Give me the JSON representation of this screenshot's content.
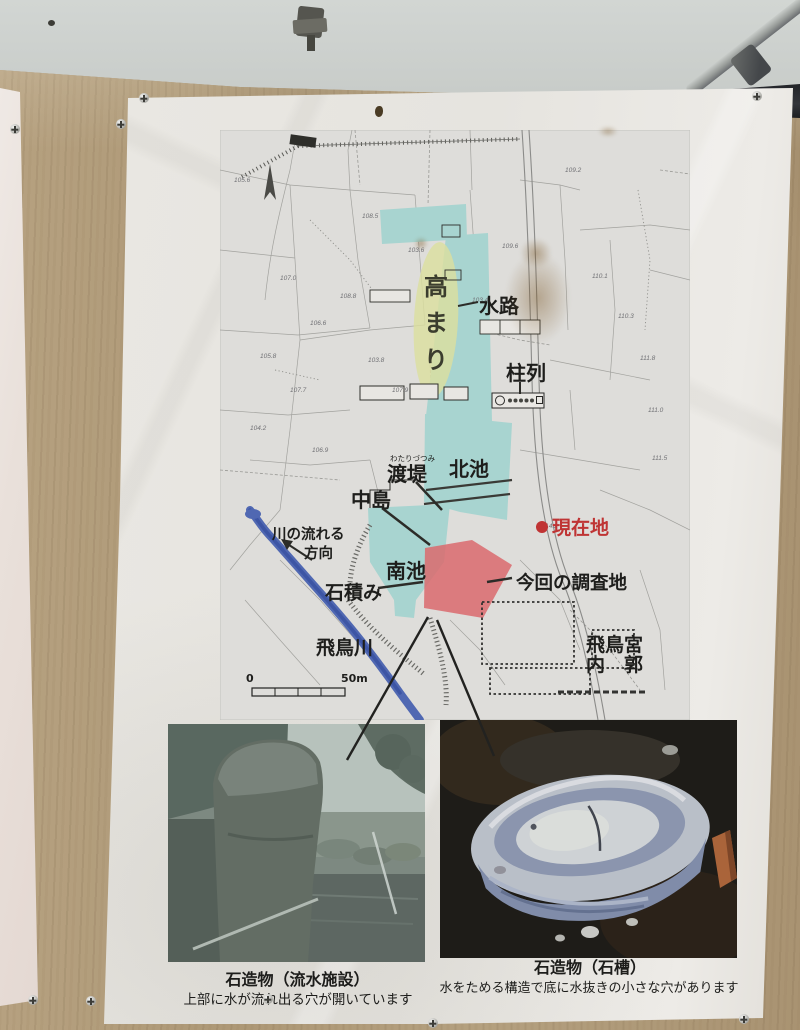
{
  "colors": {
    "sky": "#c9cdca",
    "wall_wood": "#b19c7b",
    "poster_white": "#e8e6e1",
    "map_pond_cyan": "#a8d4d0",
    "map_mound_yellow": "#dcdf9f",
    "map_survey_red": "#db6a6d",
    "map_river_blue": "#5068b2",
    "current_location_red": "#c03434",
    "label_black": "#1e1e1c"
  },
  "map": {
    "labels": {
      "takamari": [
        "高",
        "ま",
        "り"
      ],
      "suiro": "水路",
      "churetsu": "柱列",
      "watarizutsumi_furigana": "わたりづつみ",
      "watarizutsumi": "渡堤",
      "kitaike": "北池",
      "nakajima": "中島",
      "genzaichi": "現在地",
      "minamiike": "南池",
      "ishizumi": "石積み",
      "chosachi": "今回の調査地",
      "kawa_line1": "川の流れる",
      "kawa_line2": "方向",
      "asukagawa": "飛鳥川",
      "asukakyu": "飛鳥宮",
      "naikaku": "内　郭",
      "scale_zero": "0",
      "scale_fifty": "50m"
    },
    "elevations": [
      "105.6",
      "109.2",
      "108.5",
      "103.4",
      "109.6",
      "103.6",
      "107.0",
      "106.6",
      "108.8",
      "105.8",
      "107.7",
      "110.1",
      "104.2",
      "111.8",
      "110.3",
      "111.0",
      "115.3",
      "114.2",
      "106.9",
      "103.8",
      "107.9",
      "111.5"
    ]
  },
  "photos": {
    "left": {
      "title": "石造物（流水施設）",
      "caption": "上部に水が流れ出る穴が開いています"
    },
    "right": {
      "title": "石造物（石槽）",
      "caption": "水をためる構造で底に水抜きの小さな穴があります"
    }
  }
}
